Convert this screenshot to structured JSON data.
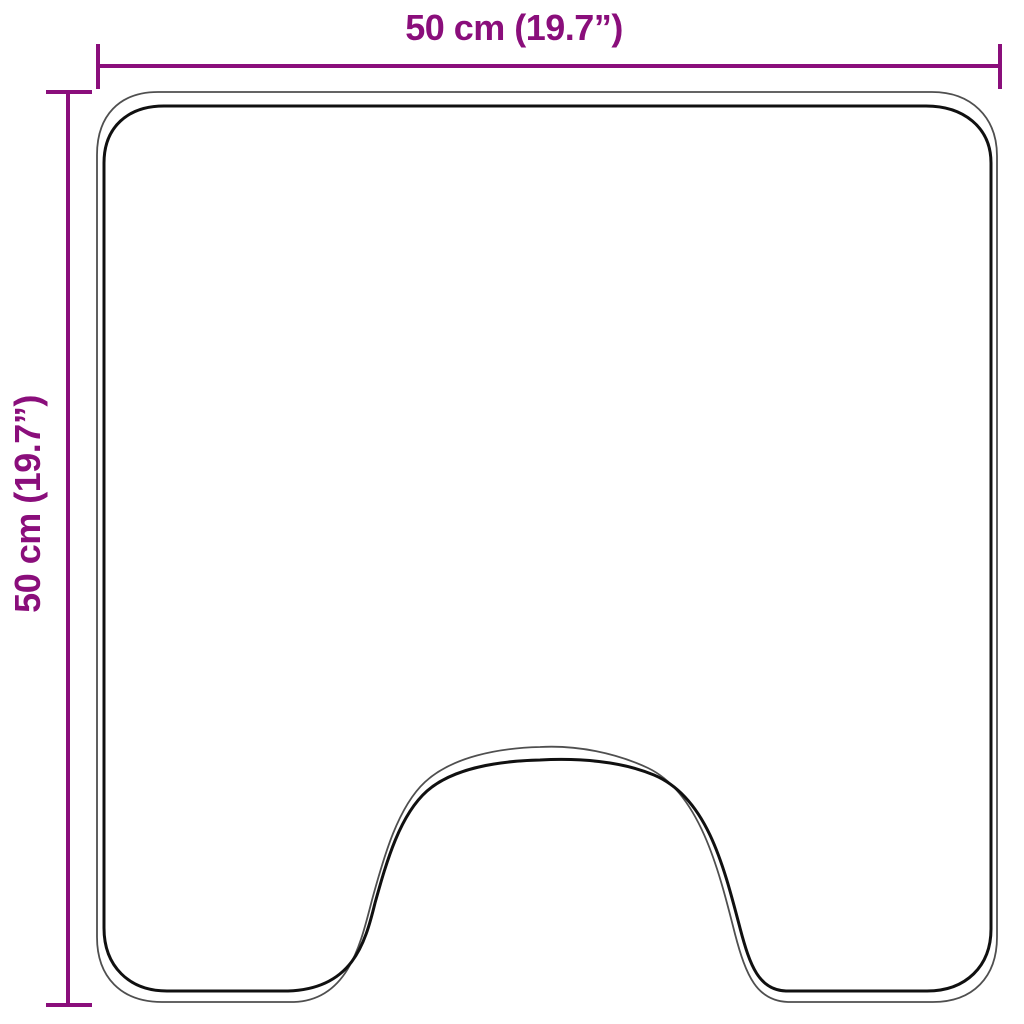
{
  "diagram": {
    "type": "product-dimension-outline",
    "shape": "contoured-pedestal-mat-with-u-cutout",
    "width_dimension": {
      "label": "50 cm (19.7”)",
      "cm": 50,
      "inches": 19.7
    },
    "height_dimension": {
      "label": "50 cm (19.7”)",
      "cm": 50,
      "inches": 19.7
    }
  },
  "colors": {
    "dimension": "#8a0e7b",
    "outline_inner": "#101010",
    "outline_outer": "#4f4f4f",
    "background": "#ffffff"
  }
}
